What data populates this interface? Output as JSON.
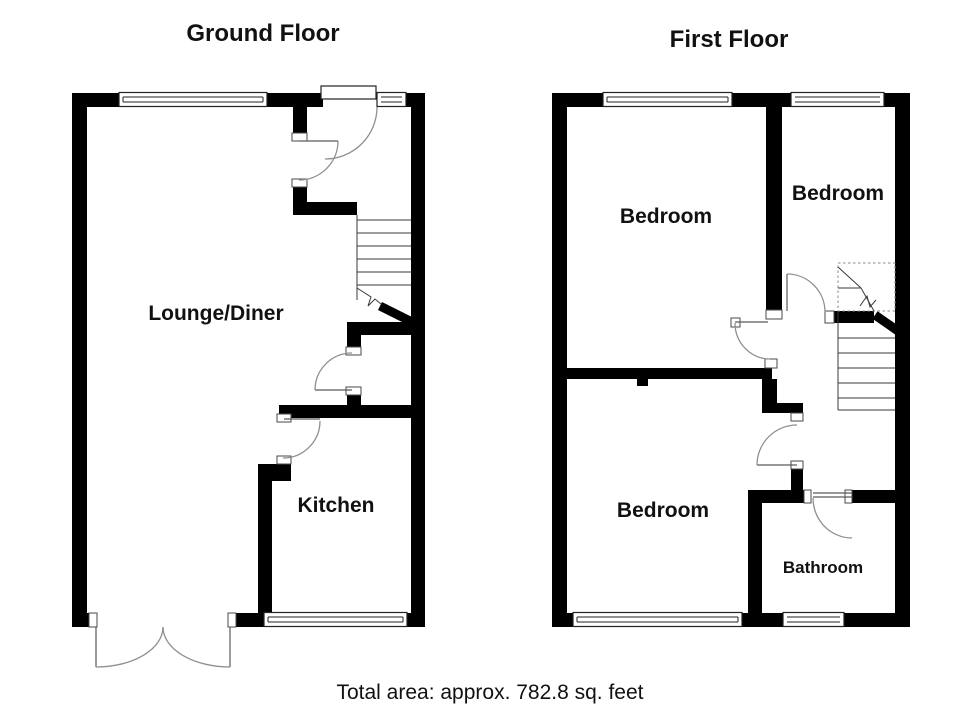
{
  "ground_floor": {
    "title": "Ground Floor",
    "rooms": {
      "lounge": "Lounge/Diner",
      "kitchen": "Kitchen"
    }
  },
  "first_floor": {
    "title": "First Floor",
    "rooms": {
      "bedroom_left": "Bedroom",
      "bedroom_right": "Bedroom",
      "bedroom_bottom": "Bedroom",
      "bathroom": "Bathroom"
    }
  },
  "footer": {
    "total_area": "Total area: approx. 782.8 sq. feet"
  },
  "colors": {
    "wall": "#000000",
    "door_arc": "#8f8f8f",
    "background": "#ffffff",
    "text": "#111111"
  }
}
